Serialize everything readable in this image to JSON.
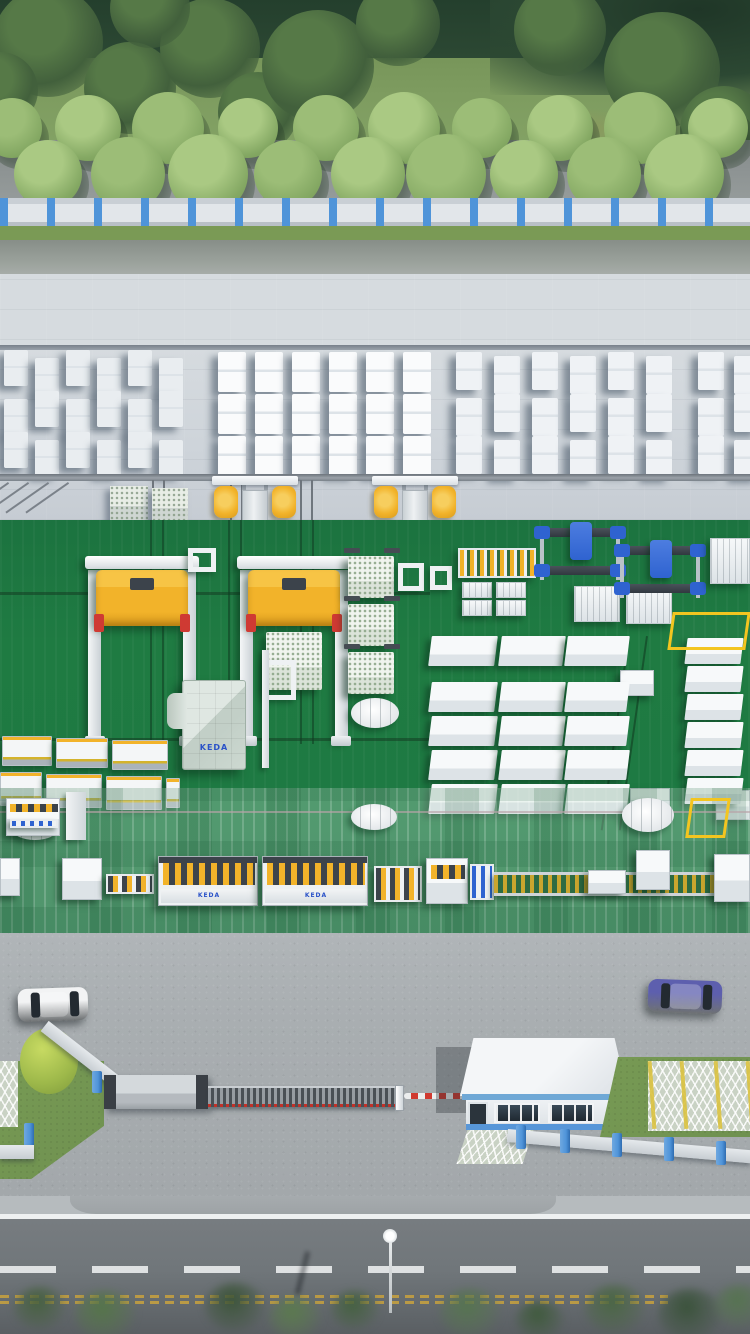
{
  "scene": {
    "title": "Aerial 3D render of an AAC block factory site",
    "brand_text": "KEDA",
    "colors": {
      "forest_dark": "#2c4833",
      "grass_dark": "#6e8c50",
      "grass": "#7e9c60",
      "grass_light": "#87a768",
      "grass_strip": "#7a9a55",
      "path_gray": "#8d9393",
      "fence_panel": "#e2e6ea",
      "fence_post_blue": "#4f94d9",
      "road_top": "#99a09a",
      "concrete": "#d6dbdf",
      "concrete_dark": "#c6ccd3",
      "floor_green": "#1f7b42",
      "machine_yellow": "#f2b32a",
      "machine_red": "#cf3a33",
      "machine_blue": "#2f63d0",
      "pavement": "#a9aeb1",
      "road_bottom": "#70767a",
      "lane_yellow": "#c9a23e",
      "barrier_red": "#d03a30",
      "lawn_green": "#6f9150",
      "car_white": "#f2f3f4",
      "car_purple": "#5d5fae",
      "car_black": "#17191c"
    },
    "forest_trees": [
      {
        "x": 48,
        "y": 42,
        "r": 55
      },
      {
        "x": 130,
        "y": 88,
        "r": 46
      },
      {
        "x": 210,
        "y": 48,
        "r": 50
      },
      {
        "x": 258,
        "y": 112,
        "r": 40
      },
      {
        "x": 318,
        "y": 66,
        "r": 56
      },
      {
        "x": 398,
        "y": 24,
        "r": 42
      },
      {
        "x": 150,
        "y": 8,
        "r": 40
      },
      {
        "x": 0,
        "y": 90,
        "r": 38
      },
      {
        "x": 560,
        "y": 30,
        "r": 46
      },
      {
        "x": 662,
        "y": 70,
        "r": 58
      },
      {
        "x": 724,
        "y": 130,
        "r": 44
      }
    ],
    "dry_patches": [
      {
        "x": 520,
        "y": 108,
        "w": 130,
        "h": 42
      },
      {
        "x": 640,
        "y": 162,
        "w": 95,
        "h": 28
      },
      {
        "x": 430,
        "y": 148,
        "w": 72,
        "h": 24
      },
      {
        "x": 55,
        "y": 150,
        "w": 62,
        "h": 20
      }
    ],
    "row_trees_back": [
      12,
      88,
      168,
      248,
      326,
      404,
      482,
      560,
      640,
      718
    ],
    "row_trees_front": [
      48,
      128,
      208,
      288,
      368,
      446,
      524,
      604,
      684
    ],
    "stack_groups": [
      {
        "x": 4,
        "y": 80,
        "cols": 6,
        "rows": 3,
        "uw": 24,
        "uh": 36,
        "gx": 31,
        "gy": 41,
        "c": "#e9edf0",
        "jitter": 4
      },
      {
        "x": 218,
        "y": 78,
        "cols": 6,
        "rows": 3,
        "uw": 28,
        "uh": 40,
        "gx": 37,
        "gy": 42,
        "c": "#fafbfc",
        "jitter": 0
      },
      {
        "x": 456,
        "y": 80,
        "cols": 6,
        "rows": 3,
        "uw": 26,
        "uh": 38,
        "gx": 38,
        "gy": 42,
        "c": "#eff2f5",
        "jitter": 2
      },
      {
        "x": 698,
        "y": 80,
        "cols": 2,
        "rows": 3,
        "uw": 26,
        "uh": 38,
        "gx": 36,
        "gy": 42,
        "c": "#eff2f5",
        "jitter": 2
      }
    ],
    "pallet_stacks": [
      {
        "x": 110,
        "y": 212,
        "w": 38,
        "h": 36
      },
      {
        "x": 152,
        "y": 214,
        "w": 36,
        "h": 36
      }
    ],
    "straddle_carriers": [
      {
        "x": 212
      },
      {
        "x": 372
      }
    ],
    "yard_rails_v": [
      152,
      163,
      230,
      241,
      300,
      311
    ],
    "yard_rails_diag": [
      8,
      28,
      48,
      68
    ],
    "gantry_cranes": [
      {
        "x": 88,
        "carry": false
      },
      {
        "x": 240,
        "carry": true
      }
    ],
    "cakes": [
      {
        "x": 348,
        "y": 36
      },
      {
        "x": 348,
        "y": 84
      },
      {
        "x": 348,
        "y": 132
      }
    ],
    "conveyor_tables": [
      {
        "x": 2,
        "y": 216,
        "w": 50,
        "h": 30
      },
      {
        "x": 56,
        "y": 218,
        "w": 52,
        "h": 30
      },
      {
        "x": 112,
        "y": 220,
        "w": 56,
        "h": 30
      },
      {
        "x": 0,
        "y": 252,
        "w": 42,
        "h": 34
      },
      {
        "x": 46,
        "y": 254,
        "w": 56,
        "h": 34
      },
      {
        "x": 106,
        "y": 256,
        "w": 56,
        "h": 34
      },
      {
        "x": 166,
        "y": 258,
        "w": 14,
        "h": 30
      }
    ],
    "frames": [
      {
        "x": 188,
        "y": 28,
        "w": 28,
        "h": 24
      },
      {
        "x": 398,
        "y": 43,
        "w": 26,
        "h": 28
      },
      {
        "x": 430,
        "y": 46,
        "w": 22,
        "h": 24
      },
      {
        "x": 264,
        "y": 140,
        "w": 32,
        "h": 40
      }
    ],
    "white_posts": [
      {
        "x": 262,
        "y": 130,
        "h": 118
      },
      {
        "x": 66,
        "y": 272,
        "h": 48
      }
    ],
    "box_columns": [
      {
        "x": 430,
        "w": 66,
        "h": 30,
        "rows": [
          116,
          162,
          196,
          230,
          264
        ]
      },
      {
        "x": 500,
        "w": 64,
        "h": 30,
        "rows": [
          116,
          162,
          196,
          230,
          264
        ]
      },
      {
        "x": 566,
        "w": 62,
        "h": 30,
        "rows": [
          116,
          162,
          196,
          230,
          264
        ]
      },
      {
        "x": 686,
        "w": 56,
        "h": 26,
        "rows": [
          118,
          146,
          174,
          202,
          230,
          258
        ]
      }
    ],
    "util_boxes": [
      {
        "x": 620,
        "y": 150,
        "w": 34,
        "h": 26
      },
      {
        "x": 630,
        "y": 268,
        "w": 40,
        "h": 22
      },
      {
        "x": 716,
        "y": 270,
        "w": 34,
        "h": 30
      }
    ],
    "turntables": [
      {
        "x": 351,
        "y": 178,
        "w": 48,
        "h": 30
      },
      {
        "x": 351,
        "y": 284,
        "w": 46,
        "h": 26
      },
      {
        "x": 622,
        "y": 278,
        "w": 52,
        "h": 34
      },
      {
        "x": 12,
        "y": 298,
        "w": 46,
        "h": 22
      }
    ],
    "yellow_rects": [
      {
        "x": 670,
        "y": 92,
        "w": 78,
        "h": 38
      },
      {
        "x": 688,
        "y": 278,
        "w": 40,
        "h": 40
      }
    ],
    "blue_gantries": [
      {
        "x": 536,
        "y": 0
      },
      {
        "x": 616,
        "y": 18
      }
    ],
    "tray_machines": [
      {
        "x": 462,
        "y": 62,
        "w": 30,
        "h": 16
      },
      {
        "x": 496,
        "y": 62,
        "w": 30,
        "h": 16
      },
      {
        "x": 462,
        "y": 80,
        "w": 30,
        "h": 16
      },
      {
        "x": 496,
        "y": 80,
        "w": 30,
        "h": 16
      },
      {
        "x": 574,
        "y": 66,
        "w": 46,
        "h": 36
      },
      {
        "x": 626,
        "y": 68,
        "w": 46,
        "h": 36
      }
    ],
    "pl_machines": [
      {
        "t": "pl-box",
        "x": 0,
        "y": 338,
        "w": 20,
        "h": 38
      },
      {
        "t": "pl-box",
        "x": 62,
        "y": 338,
        "w": 40,
        "h": 42
      },
      {
        "t": "pl-check",
        "x": 106,
        "y": 354,
        "w": 48,
        "h": 20
      },
      {
        "t": "longline",
        "x": 158,
        "y": 336,
        "w": 100,
        "h": 50
      },
      {
        "t": "longline",
        "x": 262,
        "y": 336,
        "w": 106,
        "h": 50
      },
      {
        "t": "pl-check",
        "x": 374,
        "y": 346,
        "w": 48,
        "h": 36
      },
      {
        "t": "cutter",
        "x": 426,
        "y": 338,
        "w": 42,
        "h": 46
      },
      {
        "t": "pl-blue",
        "x": 470,
        "y": 344,
        "w": 24,
        "h": 36
      },
      {
        "t": "pl-roller",
        "x": 494,
        "y": 352,
        "w": 232,
        "h": 24
      },
      {
        "t": "pl-box",
        "x": 588,
        "y": 350,
        "w": 38,
        "h": 24
      },
      {
        "t": "pl-box",
        "x": 636,
        "y": 330,
        "w": 34,
        "h": 40
      },
      {
        "t": "pl-box",
        "x": 714,
        "y": 334,
        "w": 36,
        "h": 48
      },
      {
        "t": "stripeconv",
        "x": 6,
        "y": 278,
        "w": 54,
        "h": 38
      }
    ],
    "cars": [
      {
        "name": "white-car",
        "x": 18,
        "y": 55,
        "w": 70,
        "h": 33,
        "color": "#f2f3f4",
        "vert": false,
        "rot": -2
      },
      {
        "name": "purple-car",
        "x": 648,
        "y": 47,
        "w": 74,
        "h": 33,
        "color": "#5d5fae",
        "vert": false,
        "rot": 2
      },
      {
        "name": "black-suv",
        "x": 662,
        "y": 128,
        "w": 38,
        "h": 58,
        "color": "#17191c",
        "vert": true,
        "rot": -3
      },
      {
        "name": "black-car",
        "x": 704,
        "y": 126,
        "w": 40,
        "h": 60,
        "color": "#101316",
        "vert": true,
        "rot": 2
      }
    ],
    "park_lines": [
      0,
      32,
      66,
      98
    ],
    "bottom_trees": [
      {
        "x": 40,
        "y": 1306,
        "r": 26,
        "c": "#46603f"
      },
      {
        "x": 105,
        "y": 1312,
        "r": 30,
        "c": "#557549"
      },
      {
        "x": 235,
        "y": 1304,
        "r": 30,
        "c": "#3c5439"
      },
      {
        "x": 295,
        "y": 1316,
        "r": 26,
        "c": "#5b7a4e"
      },
      {
        "x": 355,
        "y": 1308,
        "r": 24,
        "c": "#44603f"
      },
      {
        "x": 470,
        "y": 1310,
        "r": 30,
        "c": "#567450"
      },
      {
        "x": 540,
        "y": 1318,
        "r": 24,
        "c": "#3f5a3c"
      },
      {
        "x": 615,
        "y": 1306,
        "r": 30,
        "c": "#4a6643"
      },
      {
        "x": 690,
        "y": 1312,
        "r": 32,
        "c": "#3a523a"
      },
      {
        "x": 740,
        "y": 1304,
        "r": 26,
        "c": "#567450"
      }
    ]
  }
}
